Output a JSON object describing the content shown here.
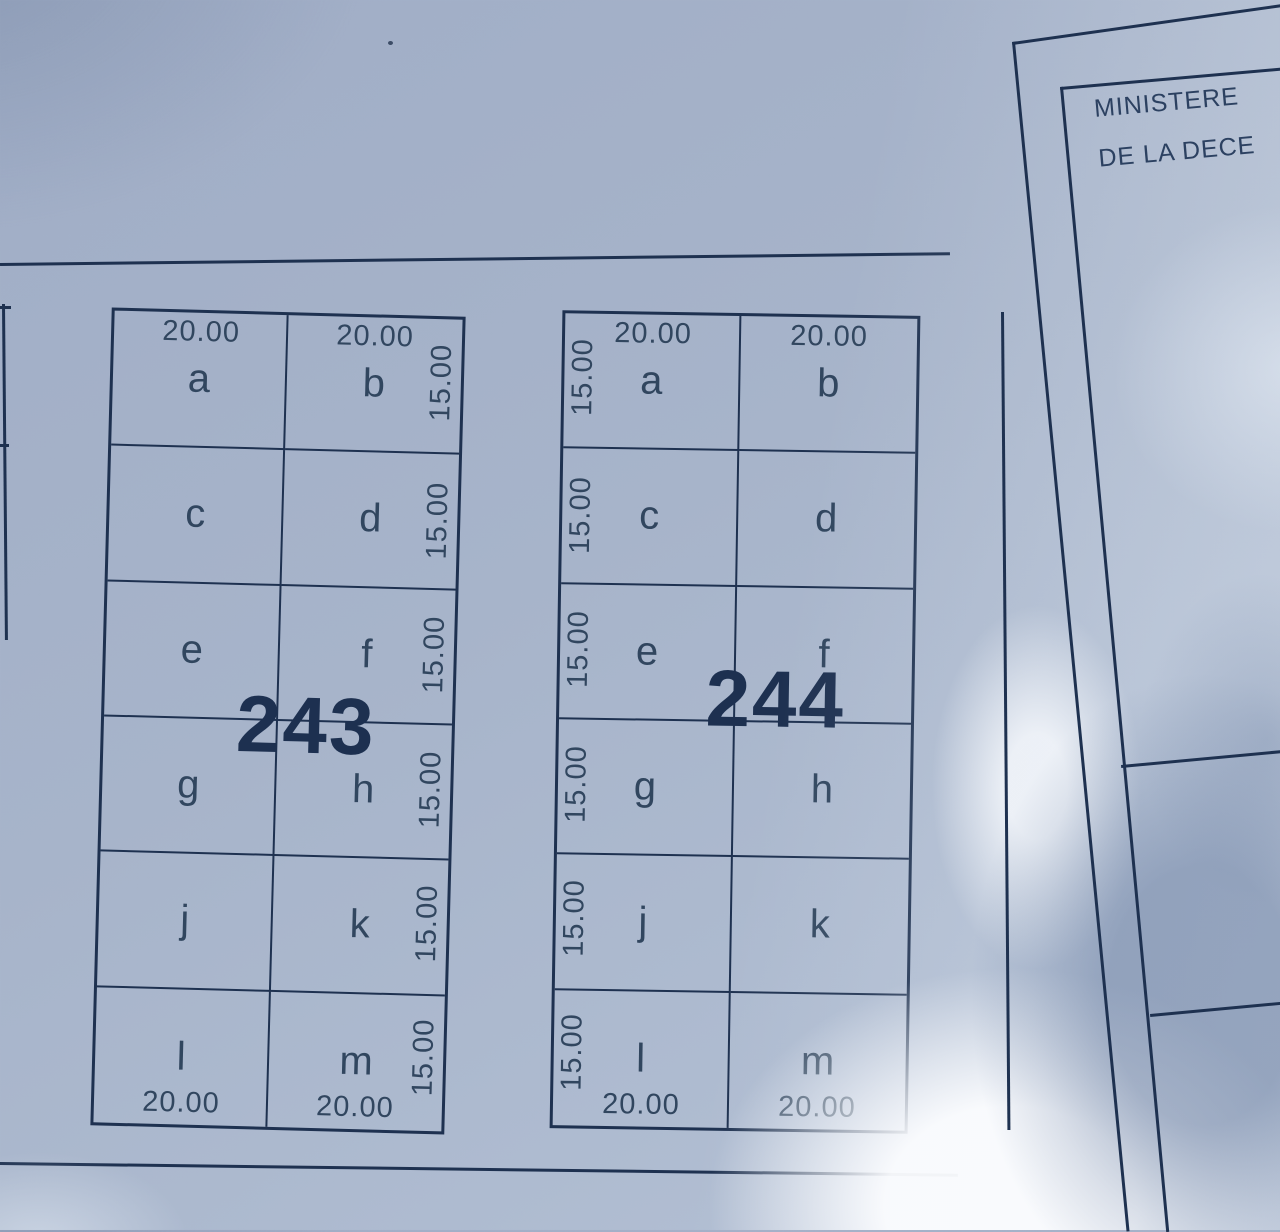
{
  "plan_sheet": {
    "blocks": [
      {
        "number": "243",
        "side_label_position": "right",
        "cells": [
          "a",
          "b",
          "c",
          "d",
          "e",
          "f",
          "g",
          "h",
          "j",
          "k",
          "l",
          "m"
        ],
        "top_dims": [
          "20.00",
          "20.00"
        ],
        "bottom_dims": [
          "20.00",
          "20.00"
        ],
        "side_dims": [
          "15.00",
          "15.00",
          "15.00",
          "15.00",
          "15.00",
          "15.00"
        ]
      },
      {
        "number": "244",
        "side_label_position": "left",
        "cells": [
          "a",
          "b",
          "c",
          "d",
          "e",
          "f",
          "g",
          "h",
          "j",
          "k",
          "l",
          "m"
        ],
        "top_dims": [
          "20.00",
          "20.00"
        ],
        "bottom_dims": [
          "20.00",
          "20.00"
        ],
        "side_dims": [
          "15.00",
          "15.00",
          "15.00",
          "15.00",
          "15.00",
          "15.00"
        ]
      }
    ]
  },
  "ministry_sheet": {
    "title_line1": "MINISTERE",
    "title_line2": "DE LA DECE"
  },
  "colors": {
    "ink": "#1e3150",
    "text": "#31465f",
    "paper_shadow": "#a7b4ca",
    "paper_highlight": "#f6f8fc",
    "hand_shadow": "#8296b5"
  }
}
